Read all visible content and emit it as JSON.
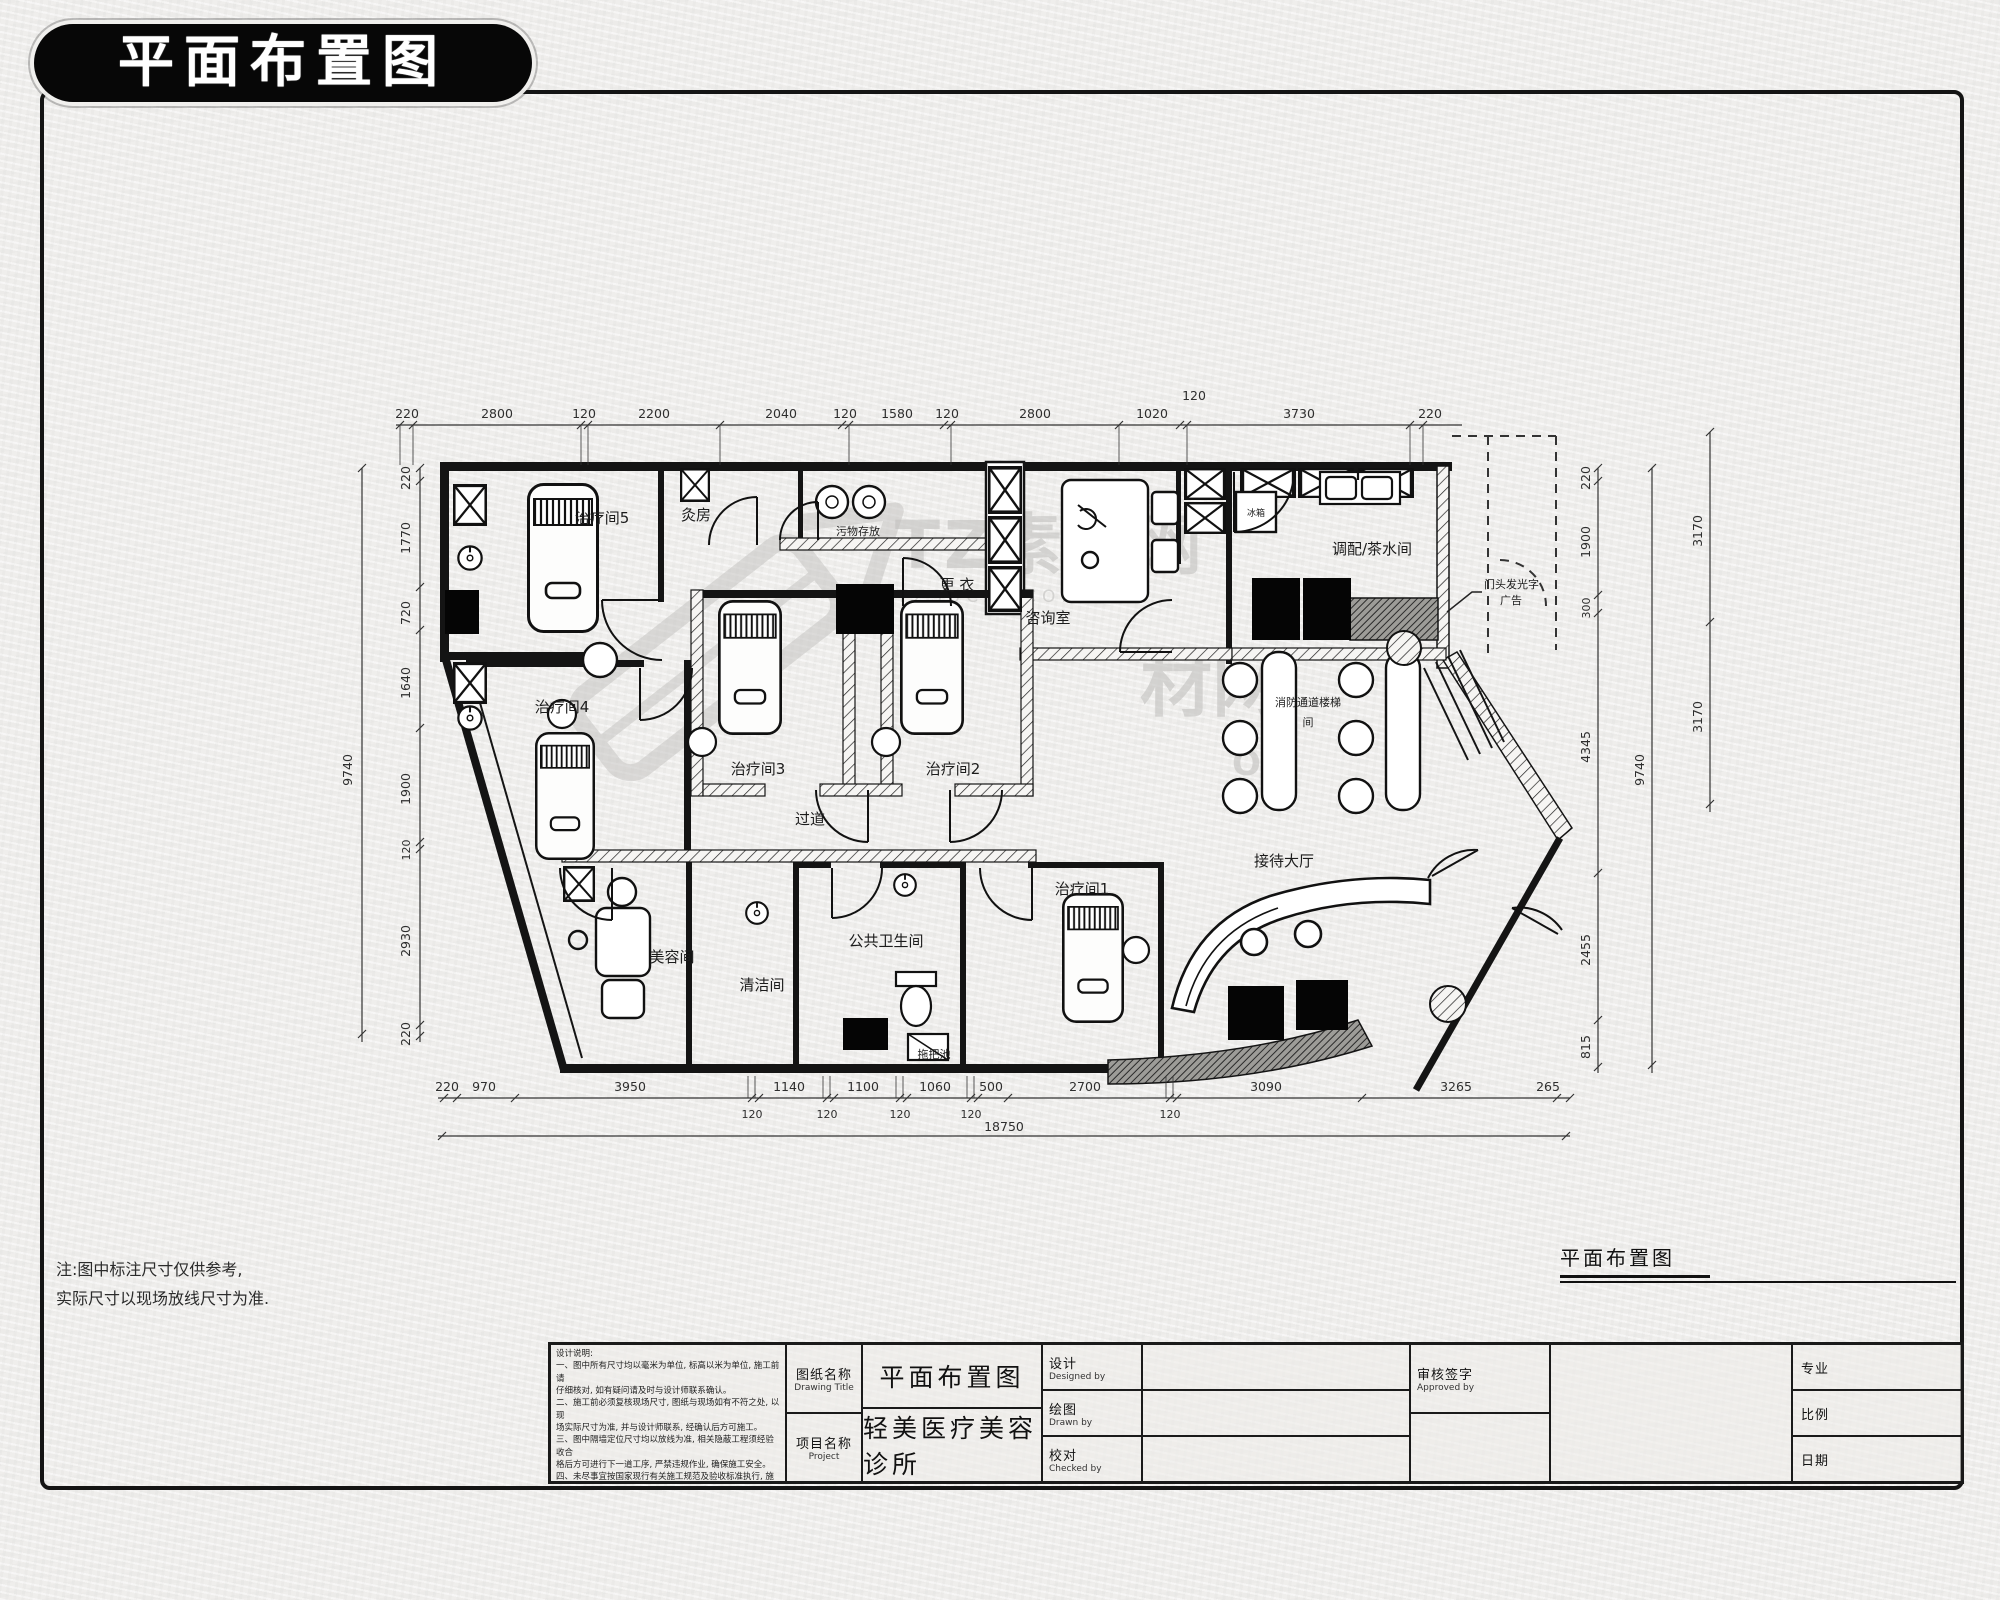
{
  "badge": {
    "title": "平面布置图"
  },
  "watermark": {
    "brand": "TZ素材网",
    "domain": "TZSUCAI.COM",
    "partial_brand": "材网",
    "partial_domain": "OM"
  },
  "plan": {
    "rooms": {
      "treatment5": "治疗间5",
      "moxa": "灸房",
      "waste": "污物存放",
      "changing": "更 衣",
      "consult": "咨询室",
      "dispense_tea": "调配/茶水间",
      "treatment4": "治疗间4",
      "treatment3": "治疗间3",
      "treatment2": "治疗间2",
      "corridor": "过道",
      "treatment1": "治疗间1",
      "beauty": "美容间",
      "cleaning": "清洁间",
      "public_wc": "公共卫生间",
      "mop_sink": "拖把池",
      "reception_hall": "接待大厅",
      "fire_stair_line1": "消防通道楼梯",
      "fire_stair_line2": "间",
      "sign_line1": "门头发光字",
      "sign_line2": "广告",
      "fridge": "冰箱"
    },
    "dims": {
      "top": [
        "220",
        "2800",
        "120",
        "2200",
        "2040",
        "120",
        "1580",
        "120",
        "2800",
        "1020",
        "120",
        "3730",
        "220"
      ],
      "bottom": [
        "220",
        "970",
        "3950",
        "1140",
        "1100",
        "1060",
        "500",
        "2700",
        "3090",
        "3265",
        "265"
      ],
      "bottom_sub": [
        "120",
        "120",
        "120",
        "120",
        "120"
      ],
      "bottom_total": "18750",
      "left": [
        "220",
        "1770",
        "720",
        "1640",
        "1900",
        "120",
        "2930",
        "220"
      ],
      "left_total": "9740",
      "right": [
        "220",
        "1900",
        "300",
        "4345",
        "2455",
        "815"
      ],
      "right_total": "9740",
      "right_far": [
        "3170",
        "3170"
      ]
    }
  },
  "notes": {
    "line1": "注:图中标注尺寸仅供参考,",
    "line2": "实际尺寸以现场放线尺寸为准."
  },
  "drawing_label": "平面布置图",
  "titleblock": {
    "notes_title": "设计说明:",
    "notes_lines": [
      "一、图中所有尺寸均以毫米为单位, 标高以米为单位, 施工前请",
      "仔细核对, 如有疑问请及时与设计师联系确认。",
      "二、施工前必须复核现场尺寸, 图纸与现场如有不符之处, 以现",
      "场实际尺寸为准, 并与设计师联系, 经确认后方可施工。",
      "三、图中隔墙定位尺寸均以放线为准, 相关隐蔽工程须经验收合",
      "格后方可进行下一道工序, 严禁违规作业, 确保施工安全。",
      "四、未尽事宜按国家现行有关施工规范及验收标准执行, 施工过",
      "程中如有变更, 以设计变更通知单为准。"
    ],
    "sheet_label_cn": "图纸名称",
    "sheet_label_en": "Drawing Title",
    "sheet_value": "平面布置图",
    "project_label_cn": "项目名称",
    "project_label_en": "Project",
    "project_value": "轻美医疗美容诊所",
    "designed_cn": "设计",
    "designed_en": "Designed by",
    "drawn_cn": "绘图",
    "drawn_en": "Drawn by",
    "checked_cn": "校对",
    "checked_en": "Checked by",
    "approved_cn": "审核签字",
    "approved_en": "Approved by",
    "pro_rows": [
      {
        "cn": "专业"
      },
      {
        "cn": "比例"
      },
      {
        "cn": "日期"
      }
    ]
  }
}
